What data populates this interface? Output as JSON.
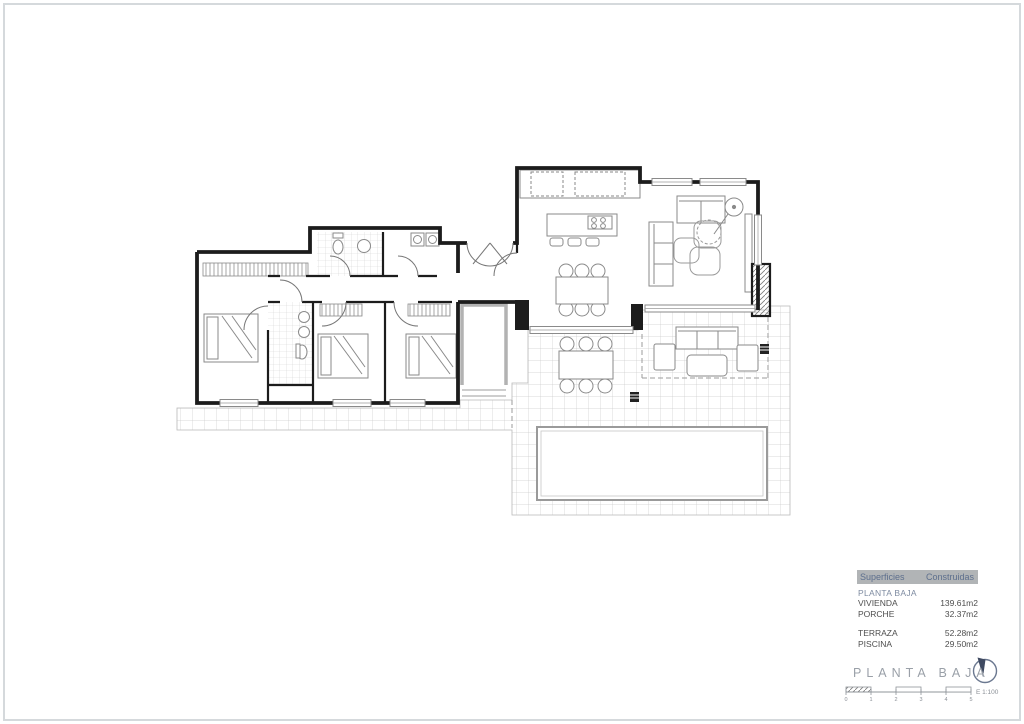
{
  "page": {
    "background": "#ffffff",
    "frame_color": "#d5d9dc",
    "accent_blue": "#5d6f8d",
    "header_gray": "#b1b4b6",
    "wall_color": "#1c1c1c",
    "tile_line_color": "#c9c9c9",
    "title_gray": "#9aa0a8"
  },
  "summary_table": {
    "header": {
      "col1": "Superficies",
      "col2": "Construidas"
    },
    "section_label": "PLANTA BAJA",
    "groups": [
      {
        "rows": [
          {
            "label": "VIVIENDA",
            "value": "139.61m2"
          },
          {
            "label": "PORCHE",
            "value": "32.37m2"
          }
        ]
      },
      {
        "rows": [
          {
            "label": "TERRAZA",
            "value": "52.28m2"
          },
          {
            "label": "PISCINA",
            "value": "29.50m2"
          }
        ]
      }
    ]
  },
  "titleblock": {
    "title": "PLANTA BAJA",
    "scale_label": "E 1:100",
    "scale_ticks": [
      "0",
      "1",
      "2",
      "3",
      "4",
      "5"
    ],
    "icons": {
      "north_arrow": "north-arrow-icon"
    }
  }
}
